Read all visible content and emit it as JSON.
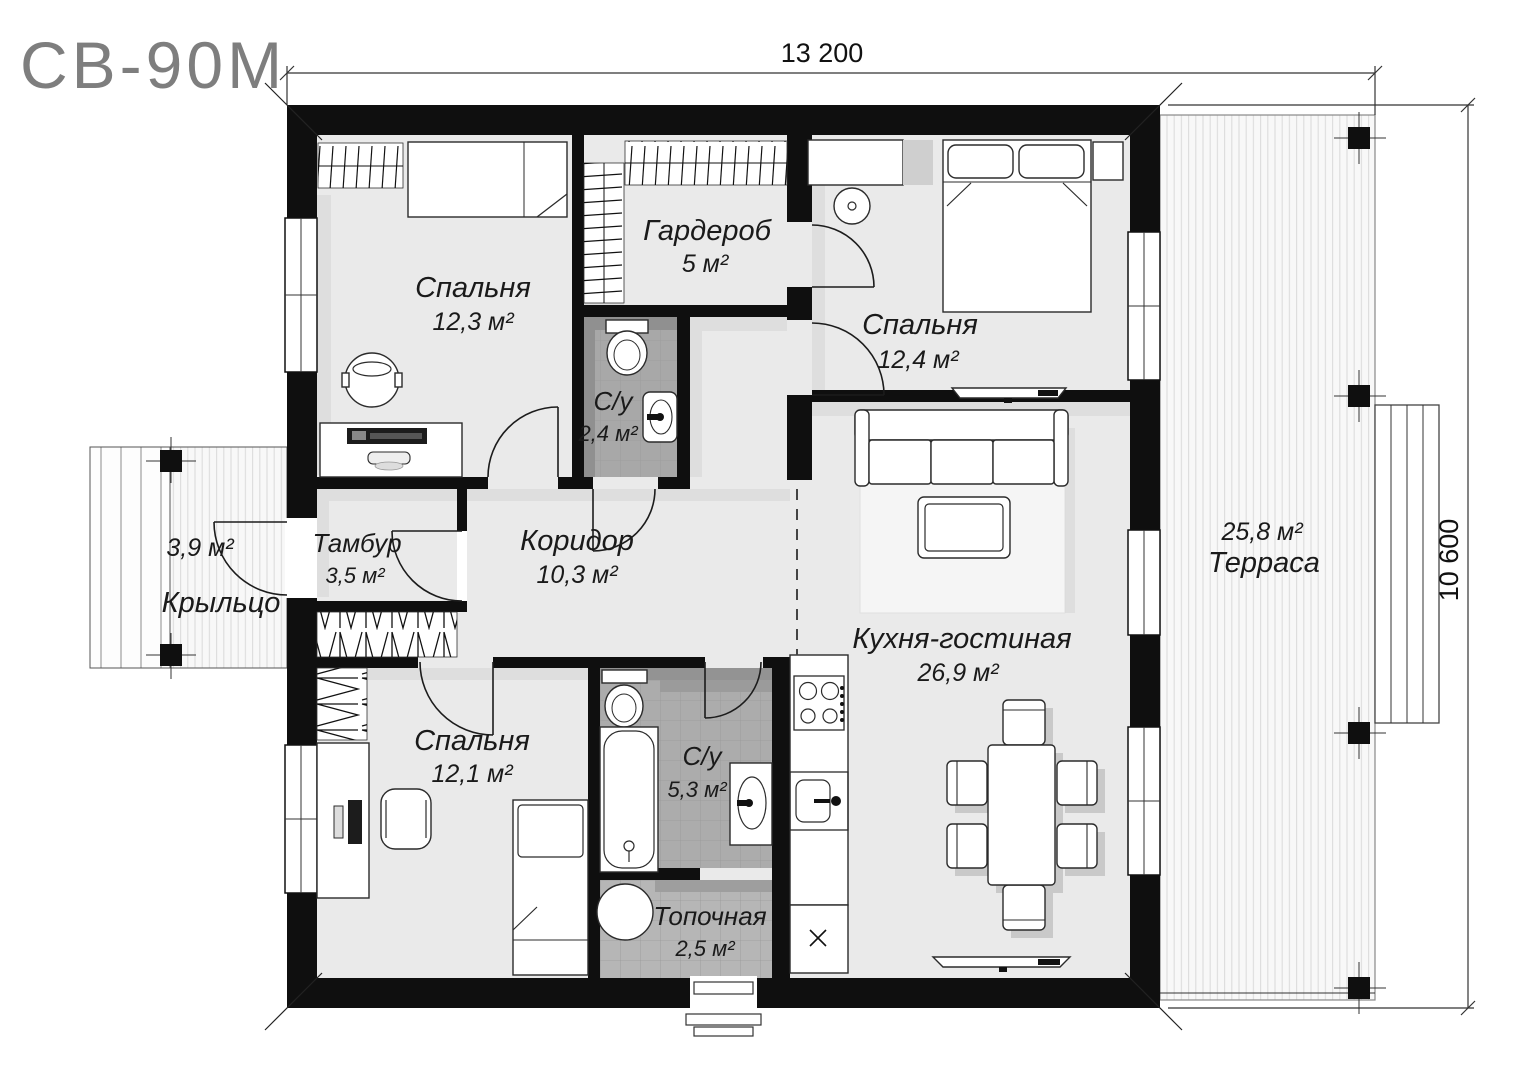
{
  "title": "СВ-90М",
  "dimensions": {
    "width_label": "13 200",
    "height_label": "10 600"
  },
  "rooms": {
    "bedroom1": {
      "name": "Спальня",
      "area": "12,3 м²"
    },
    "wardrobe": {
      "name": "Гардероб",
      "area": "5 м²"
    },
    "bathroom_small": {
      "name": "С/у",
      "area": "2,4 м²"
    },
    "bedroom2": {
      "name": "Спальня",
      "area": "12,4 м²"
    },
    "vestibule": {
      "name": "Тамбур",
      "area": "3,5 м²"
    },
    "corridor": {
      "name": "Коридор",
      "area": "10,3 м²"
    },
    "kitchen_living": {
      "name": "Кухня-гостиная",
      "area": "26,9 м²"
    },
    "bedroom3": {
      "name": "Спальня",
      "area": "12,1 м²"
    },
    "bathroom_big": {
      "name": "С/у",
      "area": "5,3 м²"
    },
    "boiler_room": {
      "name": "Топочная",
      "area": "2,5 м²"
    },
    "terrace": {
      "name": "Терраса",
      "area": "25,8 м²"
    },
    "porch": {
      "name": "Крыльцо",
      "area": "3,9 м²"
    }
  }
}
